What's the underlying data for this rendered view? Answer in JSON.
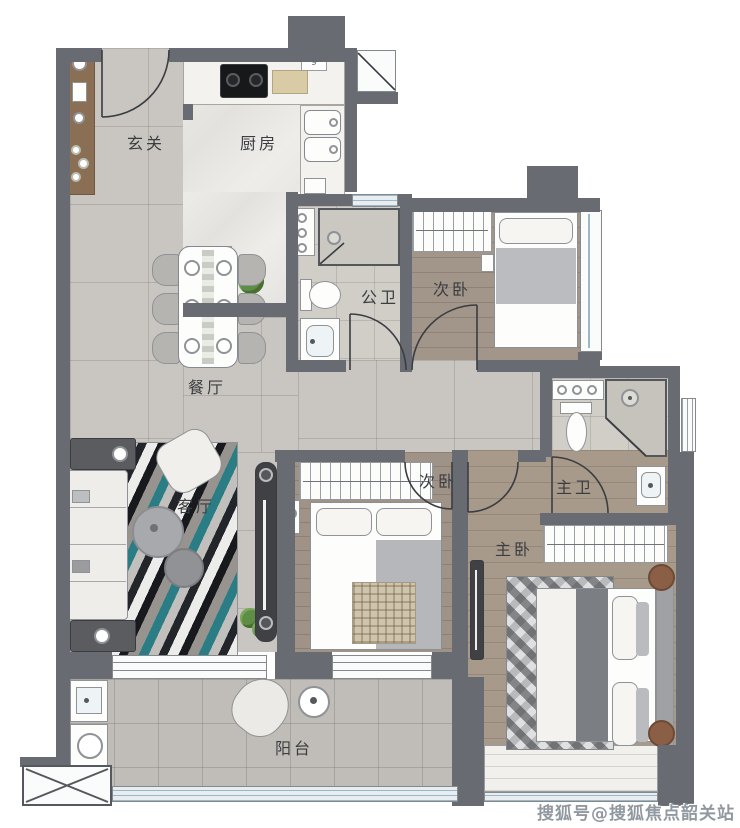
{
  "rooms": {
    "entry": {
      "label": "玄关"
    },
    "kitchen": {
      "label": "厨房"
    },
    "public_bath": {
      "label": "公卫"
    },
    "bedroom_top": {
      "label": "次卧"
    },
    "dining": {
      "label": "餐厅"
    },
    "living": {
      "label": "客厅"
    },
    "bedroom_mid": {
      "label": "次卧"
    },
    "master_bath": {
      "label": "主卫"
    },
    "master_bedroom": {
      "label": "主卧"
    },
    "balcony": {
      "label": "阳台"
    }
  },
  "annotations": {
    "counter_marker": "9"
  },
  "watermark": {
    "text": "搜狐号@搜狐焦点韶关站"
  },
  "colors": {
    "wall": "#686c72",
    "tile": "#c9c6c1",
    "bath_tile": "#d1cec8",
    "wood": "#a89a8b",
    "marble": "#eae8e4",
    "accent_teal": "#2a7d85",
    "window_blue": "#9db6c4",
    "cabinet_wood": "#8a6f54"
  }
}
